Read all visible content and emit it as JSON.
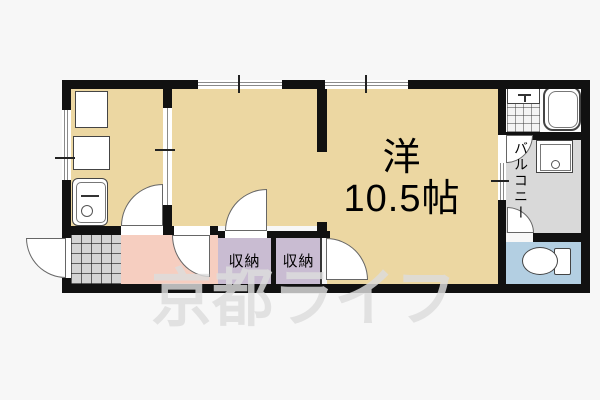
{
  "watermark": {
    "text": "京都ライフ"
  },
  "rooms": {
    "main": {
      "label": "洋",
      "size": "10.5帖"
    },
    "storage1": {
      "label": "収納"
    },
    "storage2": {
      "label": "収納"
    },
    "balcony": {
      "label": "バルコニー"
    }
  },
  "colors": {
    "background": "#f7f7f7",
    "wall": "#111111",
    "room-floor": "#ecd7a2",
    "storage-floor": "#c9bcd2",
    "hallway-floor": "#f6cec0",
    "toilet-floor": "#b3cfe2",
    "balcony-floor": "#d9d9d9",
    "tile-floor": "#d4d4d4",
    "watermark": "#dddddd"
  }
}
